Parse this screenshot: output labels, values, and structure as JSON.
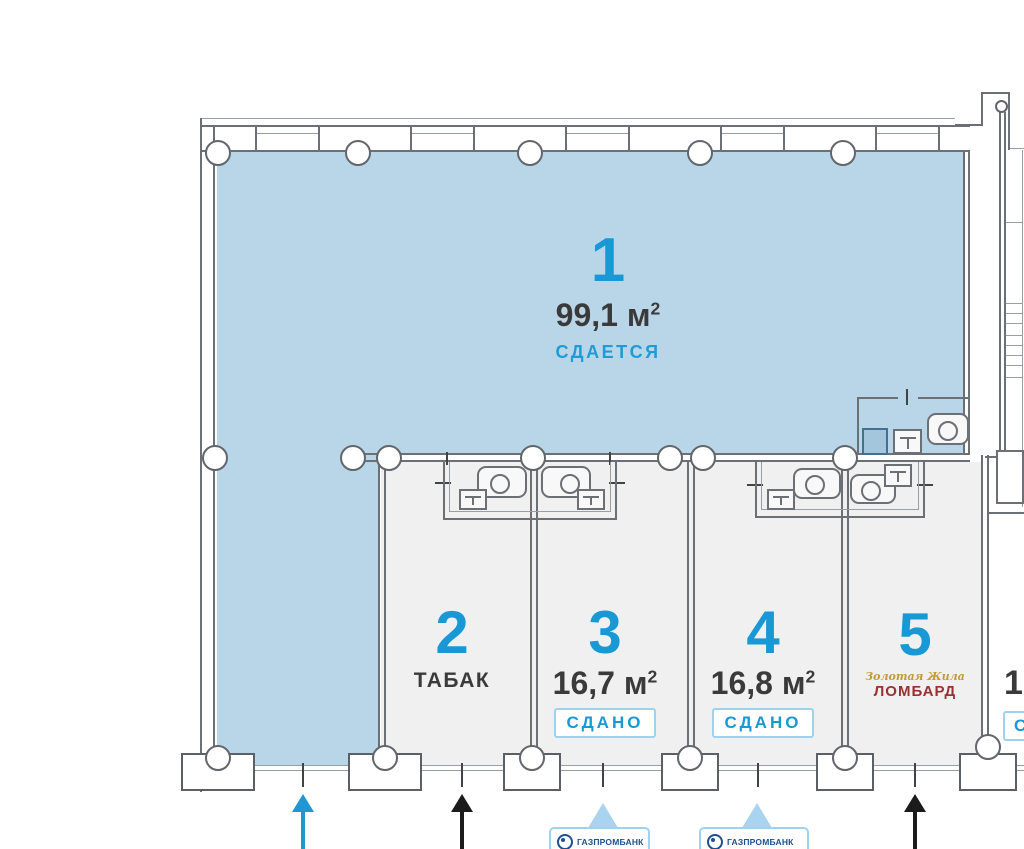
{
  "units": [
    {
      "number": "1",
      "area": "99,1",
      "area_unit": "м",
      "area_sup": "2",
      "status": "СДАЕТСЯ"
    },
    {
      "number": "2",
      "tenant": "ТАБАК"
    },
    {
      "number": "3",
      "area": "16,7",
      "area_unit": "м",
      "area_sup": "2",
      "status": "СДАНО"
    },
    {
      "number": "4",
      "area": "16,8",
      "area_unit": "м",
      "area_sup": "2",
      "status": "СДАНО"
    },
    {
      "number": "5",
      "tenant_brand_script": "Золотая Жила",
      "tenant": "ЛОМБАРД"
    },
    {
      "area_partial": "1",
      "status_partial": "С"
    }
  ],
  "atm": {
    "label": "ГАЗПРОМБАНК"
  },
  "colors": {
    "room_available_fill": "#b9d6e9",
    "unit_fill": "#f0f0f0",
    "unit_number": "#1899d6",
    "area_text": "#3a3a3a",
    "status_available": "#1e9cd7",
    "status_rented": "#1899d6",
    "badge_border": "#9ed3ef",
    "lombard_text": "#9b2f31",
    "lombard_script": "#c39b35",
    "atm_text": "#1d4f91",
    "atm_triangle": "#a9d3ee",
    "arrow_blue": "#2196d4",
    "arrow_black": "#1b1b1b",
    "wall": "#6a7076"
  }
}
